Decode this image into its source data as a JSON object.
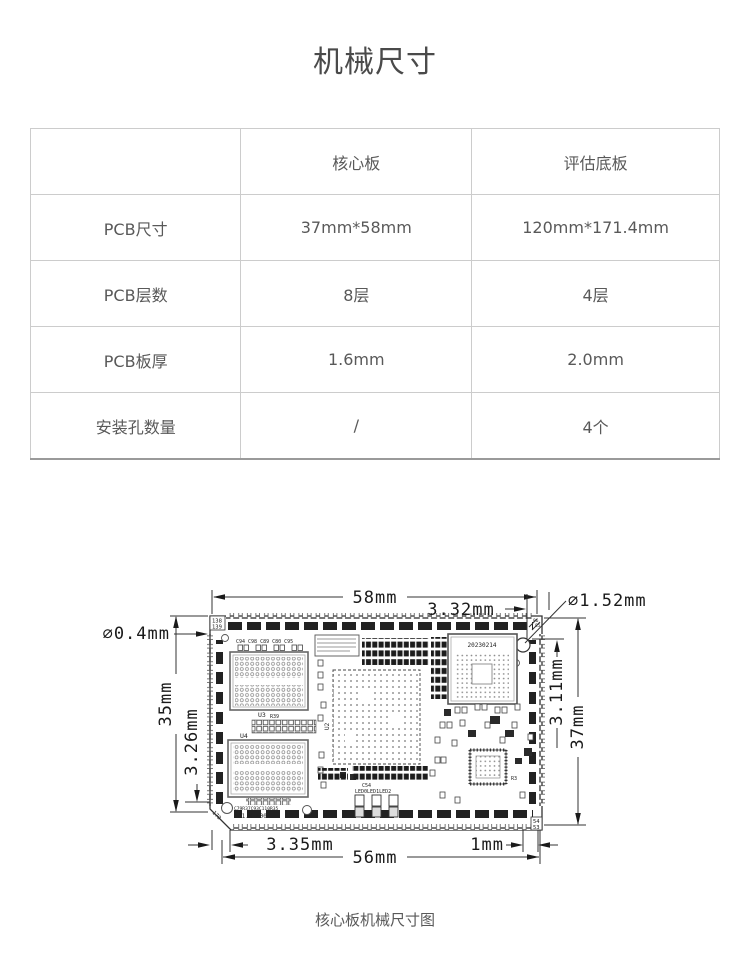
{
  "page": {
    "title": "机械尺寸",
    "caption": "核心板机械尺寸图"
  },
  "table": {
    "headers": [
      "",
      "核心板",
      "评估底板"
    ],
    "rows": [
      {
        "label": "PCB尺寸",
        "core": "37mm*58mm",
        "base": "120mm*171.4mm"
      },
      {
        "label": "PCB层数",
        "core": "8层",
        "base": "4层"
      },
      {
        "label": "PCB板厚",
        "core": "1.6mm",
        "base": "2.0mm"
      },
      {
        "label": "安装孔数量",
        "core": "/",
        "base": "4个"
      }
    ]
  },
  "diagram": {
    "dims": {
      "top_width": "58mm",
      "top_hole_offset": "3.32mm",
      "hole_diameter": "∅1.52mm",
      "pad_diameter": "∅0.4mm",
      "left_height": "35mm",
      "left_offset": "3.26mm",
      "right_offset": "3.11mm",
      "right_height": "37mm",
      "bottom_left_offset": "3.35mm",
      "bottom_width": "56mm",
      "bottom_right_offset": "1mm"
    },
    "silkscreen": {
      "pin_tl_top": "138",
      "pin_tl_bottom": "139",
      "pin_corner": "170",
      "pin_br_top": "54",
      "pin_br_bottom": "53",
      "pin_tr_top": "86",
      "pin_tr_bottom": "85",
      "date_code": "20230214",
      "version": "A1.0-000",
      "bottom_refs": "C79R37C93C110R35",
      "caps_row": "C94  C98  C89   C80  C95",
      "u2": "U2",
      "u3": "U3",
      "u4": "U4",
      "r39": "R39",
      "c54": "C54",
      "r3": "R3",
      "led_labels": "LED0LED1LED2"
    }
  },
  "colors": {
    "title_text": "#4a4a4a",
    "body_text": "#595959",
    "table_border": "#cccccc",
    "drawing_ink": "#1a1a1a"
  }
}
